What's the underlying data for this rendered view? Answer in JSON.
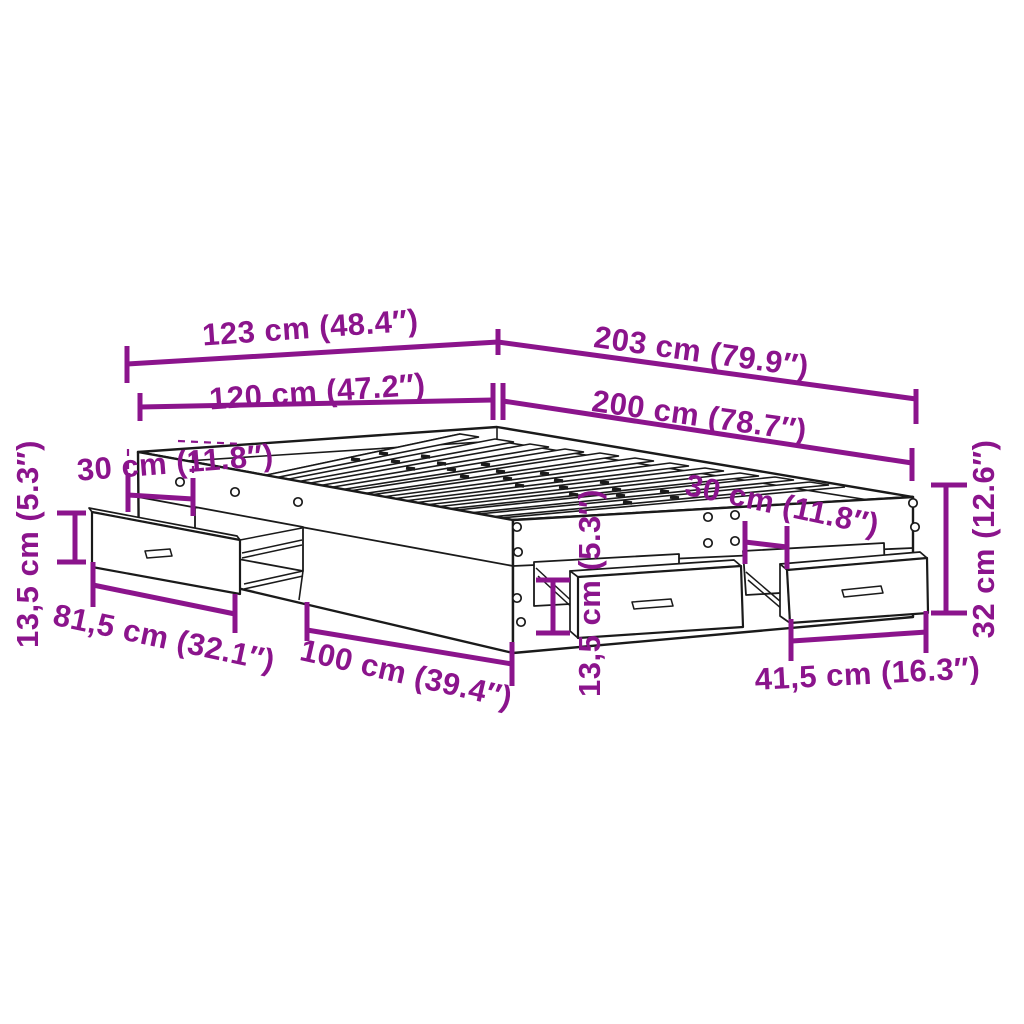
{
  "diagram": {
    "kind": "furniture-dimension-diagram",
    "subject": "bed-frame-with-storage-drawers",
    "background_color": "#ffffff",
    "outline_color": "#1a1a1a",
    "dimension_color": "#8B148C",
    "labels": {
      "width_overall": "123 cm (48.4″)",
      "length_overall": "203 cm (79.9″)",
      "width_inner": "120 cm (47.2″)",
      "length_inner": "200 cm (78.7″)",
      "side_offset": "30 cm (11.8″)",
      "side_drawer_height": "13,5 cm (5.3″)",
      "side_drawer_width": "81,5 cm (32.1″)",
      "side_panel_length": "100 cm (39.4″)",
      "foot_drawer_height": "13,5 cm (5.3″)",
      "foot_gap": "30 cm (11.8″)",
      "frame_height": "32 cm (12.6″)",
      "foot_drawer_width": "41,5 cm (16.3″)"
    }
  }
}
